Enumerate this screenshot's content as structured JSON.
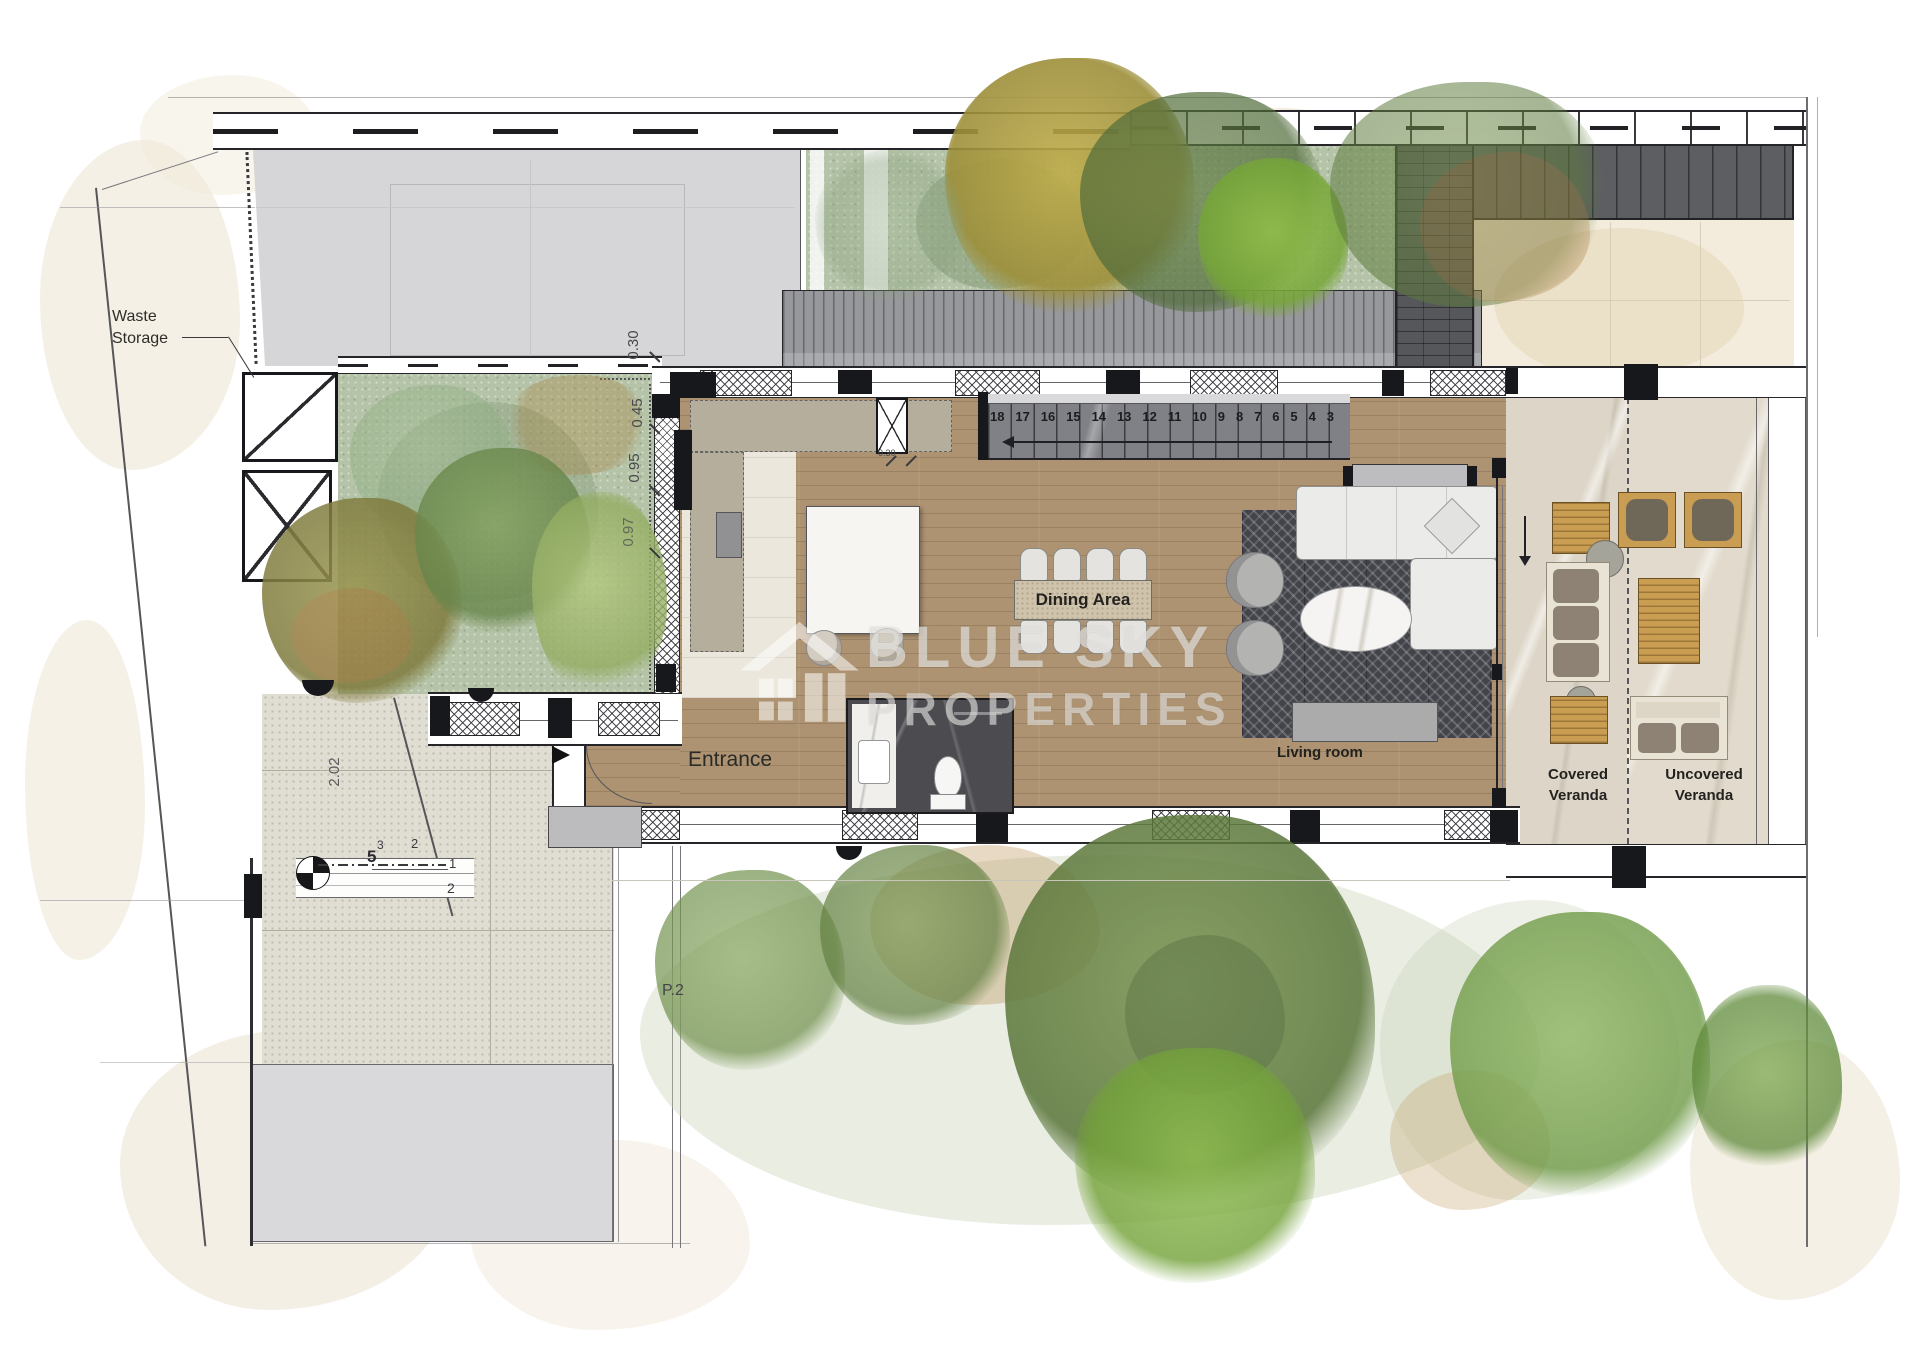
{
  "watermark": {
    "line1": "BLUE SKY",
    "line2": "PROPERTIES"
  },
  "rooms": {
    "entrance": "Entrance",
    "dining": "Dining Area",
    "living": "Living room",
    "covered_veranda": [
      "Covered",
      "Veranda"
    ],
    "uncovered_veranda": [
      "Uncovered",
      "Veranda"
    ],
    "waste_storage": [
      "Waste",
      "Storage"
    ]
  },
  "site": {
    "parcel": "P.2"
  },
  "stairs": {
    "numbers": [
      "18",
      "17",
      "16",
      "15",
      "14",
      "13",
      "12",
      "11",
      "10",
      "9",
      "8",
      "7",
      "6",
      "5",
      "4",
      "3"
    ]
  },
  "exterior_steps": {
    "n3": "3",
    "n5": "5",
    "n2a": "2",
    "n1": "1",
    "n2b": "2"
  },
  "dimensions": {
    "offset_top": "0.30",
    "offset_mid": "0.45",
    "offset_low": "0.95",
    "offset_bottom": "0.97",
    "entry_depth": "2.02",
    "niche": "0.30"
  },
  "colors": {
    "wood_floor": "#ad9372",
    "garden_green": "#b5c4a8",
    "deck_gray": "#97989b",
    "pergola_gray": "#5d5e62",
    "stair_marble": "#808186",
    "rug_charcoal": "#42444a",
    "dining_travertine": "#cfc3ac",
    "veranda_stone": "#ddd6c8",
    "counter_taupe": "#b6ae9c",
    "wc_marble_dark": "#4b4b50",
    "outdoor_wood": "#c99d52",
    "cushion_taupe": "#8d8273",
    "watermark": "#ffffff"
  }
}
